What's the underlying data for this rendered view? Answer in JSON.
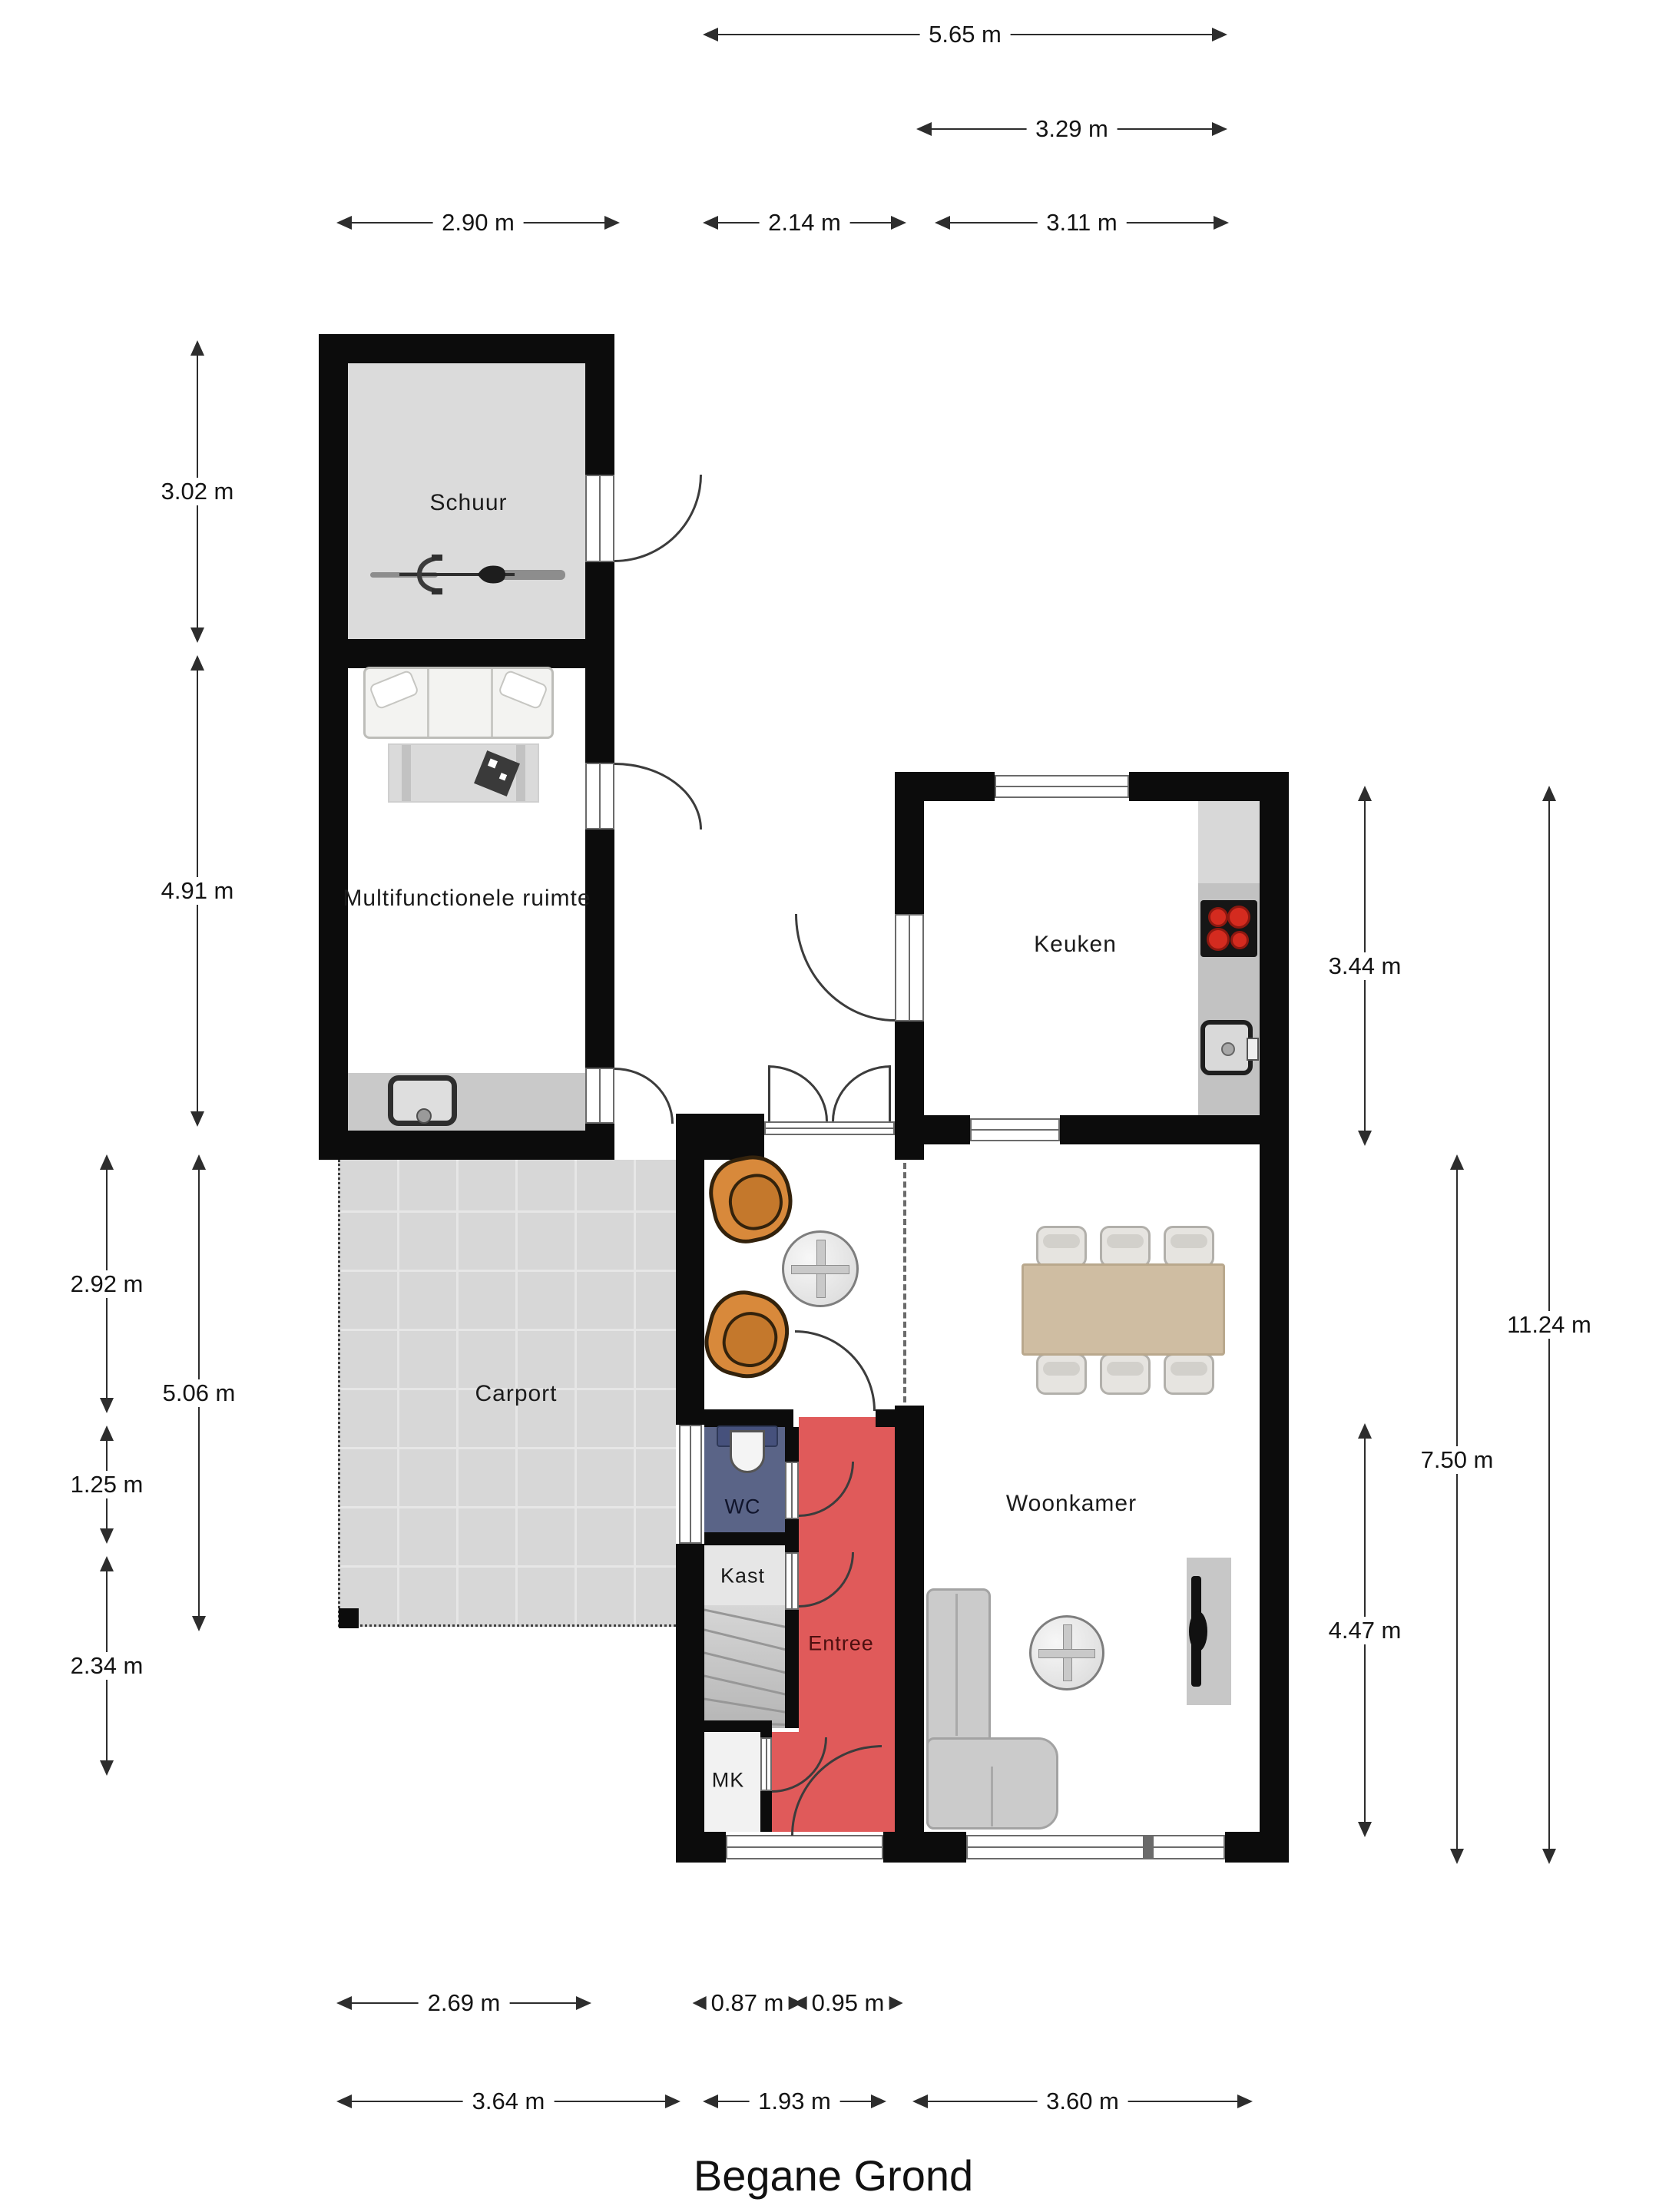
{
  "title": "Begane Grond",
  "rooms": {
    "schuur": "Schuur",
    "multifunctionele_ruimte": "Multifunctionele ruimte",
    "keuken": "Keuken",
    "carport": "Carport",
    "woonkamer": "Woonkamer",
    "wc": "WC",
    "kast": "Kast",
    "entree": "Entree",
    "mk": "MK"
  },
  "dims": {
    "d565": "5.65 m",
    "d329": "3.29 m",
    "d290": "2.90 m",
    "d214": "2.14 m",
    "d311": "3.11 m",
    "d302": "3.02 m",
    "d491": "4.91 m",
    "d292": "2.92 m",
    "d125": "1.25 m",
    "d234": "2.34 m",
    "d506": "5.06 m",
    "d344": "3.44 m",
    "d750": "7.50 m",
    "d1124": "11.24 m",
    "d447": "4.47 m",
    "d269": "2.69 m",
    "d087": "0.87 m",
    "d095": "0.95 m",
    "d364": "3.64 m",
    "d193": "1.93 m",
    "d360": "3.60 m"
  },
  "colors": {
    "wall": "#0c0c0c",
    "schuur_floor": "#dbdbdb",
    "carport_floor": "#d7d7d7",
    "wc_floor": "#5a6487",
    "entree_floor": "#e05a5a",
    "kast_floor": "#e6e6e6",
    "counter_gray": "#c2c2c2",
    "burner_red": "#d42b1f",
    "chair_orange": "#d8893b",
    "dining_table": "#cfbda2"
  }
}
